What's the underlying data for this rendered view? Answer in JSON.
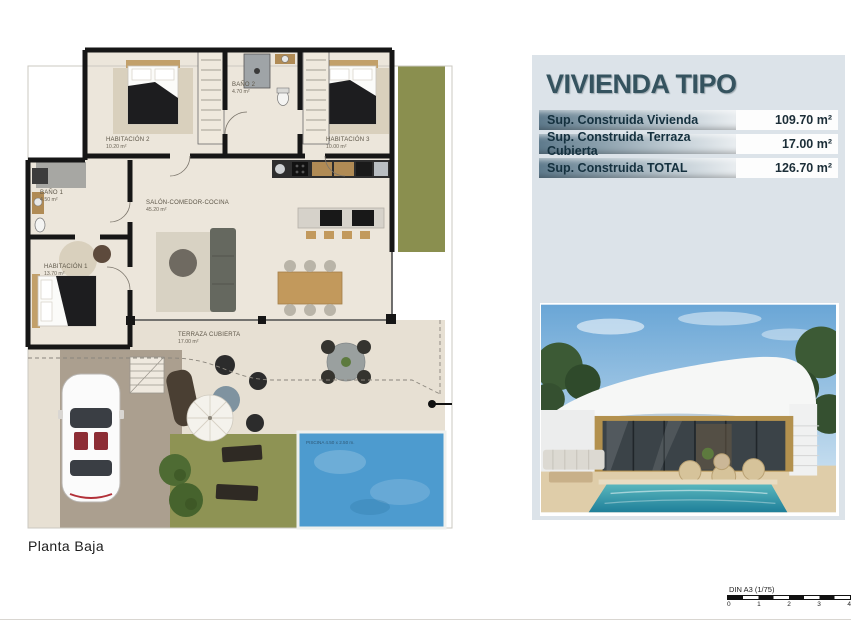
{
  "page": {
    "plan_name": "Planta Baja",
    "scale_label": "DIN A3 (1/75)",
    "scale_ticks": [
      "0",
      "1",
      "2",
      "3",
      "4"
    ]
  },
  "info_panel": {
    "title": "VIVIENDA TIPO",
    "rows": [
      {
        "label": "Sup. Construida Vivienda",
        "value": "109.70 m²"
      },
      {
        "label": "Sup. Construida Terraza Cubierta",
        "value": "17.00 m²"
      },
      {
        "label": "Sup. Construida TOTAL",
        "value": "126.70 m²"
      }
    ],
    "accent_color": "#35535f",
    "panel_bg": "#dce3e9"
  },
  "floor_plan": {
    "rooms": [
      {
        "name": "HABITACIÓN 2",
        "area": "10.20 m²"
      },
      {
        "name": "BAÑO 2",
        "area": "4.70 m²"
      },
      {
        "name": "HABITACIÓN 3",
        "area": "10.00 m²"
      },
      {
        "name": "BAÑO 1",
        "area": "4.50 m²"
      },
      {
        "name": "HABITACIÓN 1",
        "area": "13.70 m²"
      },
      {
        "name": "SALÓN-COMEDOR-COCINA",
        "area": "45.20 m²"
      },
      {
        "name": "TERRAZA CUBIERTA",
        "area": "17.00 m²"
      }
    ],
    "pool_label": "PISCINA 4.50 x 2.50 m.",
    "grass_color": "#8a8f4f",
    "pool_color": "#4d9bcf"
  }
}
